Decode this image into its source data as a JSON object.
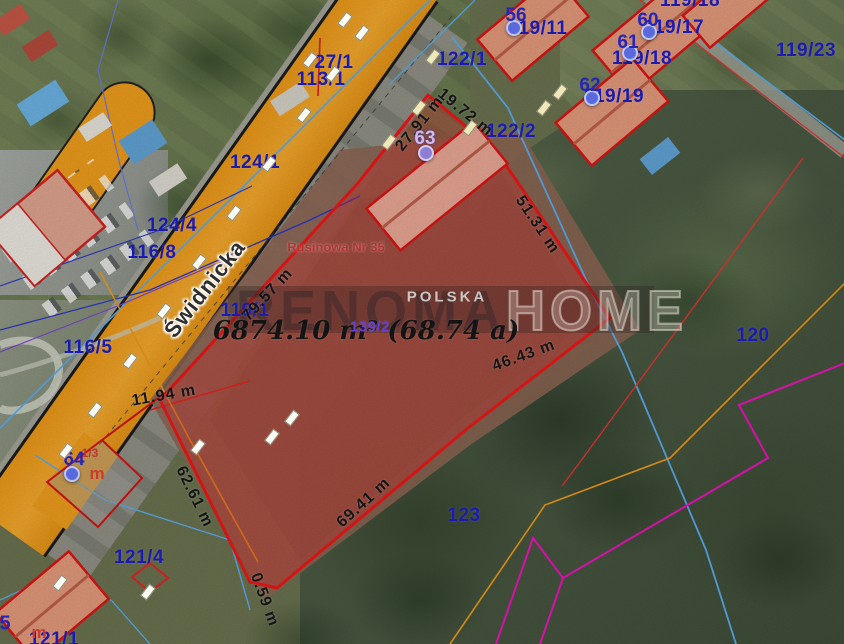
{
  "colors": {
    "parcel_outline": "#e81616",
    "parcel_fill": "rgba(221,40,40,0.33)",
    "soil_fill": "#8a6351",
    "road_orange": "#e8991c",
    "cadastral_blue": "#58a8e8",
    "cadastral_navy": "#2a35c0",
    "cadastral_purple": "#7744cc",
    "cadastral_magenta": "#ea12b8",
    "cadastral_orange": "#e8971a",
    "cadastral_red": "#dd3333",
    "label_blue": "#1b1bb0",
    "label_purple": "#6a3fd0",
    "measure_black": "#151515",
    "building_fill": "#dd9678",
    "building_outline": "#d41414",
    "marker_blue": "#5a6ade",
    "marker_purple": "#8d7fd6",
    "address_red": "#b43434"
  },
  "map": {
    "street_name": "Świdnicka",
    "address_text": "Rusinowa Nr 35",
    "country_watermark": "POLSKA",
    "area_text": "6874.10 m² (68.74 a)",
    "watermark": {
      "left": "RENOMA",
      "right": "HOME"
    },
    "parcel_labels": [
      {
        "text": "122/1",
        "x": 462,
        "y": 60
      },
      {
        "text": "27/1",
        "x": 334,
        "y": 63
      },
      {
        "text": "113/1",
        "x": 321,
        "y": 80
      },
      {
        "text": "124/1",
        "x": 255,
        "y": 163
      },
      {
        "text": "124/4",
        "x": 172,
        "y": 226
      },
      {
        "text": "116/8",
        "x": 152,
        "y": 253
      },
      {
        "text": "119/1",
        "x": 245,
        "y": 311
      },
      {
        "text": "116/5",
        "x": 88,
        "y": 348
      },
      {
        "text": "122/2",
        "x": 511,
        "y": 132
      },
      {
        "text": "119/23",
        "x": 806,
        "y": 51
      },
      {
        "text": "120",
        "x": 753,
        "y": 336
      },
      {
        "text": "123",
        "x": 464,
        "y": 516
      },
      {
        "text": "121/4",
        "x": 139,
        "y": 558
      },
      {
        "text": "121/1",
        "x": 54,
        "y": 640
      },
      {
        "text": "119/11",
        "x": 538,
        "y": 29
      },
      {
        "text": "119/17",
        "x": 674,
        "y": 28
      },
      {
        "text": "119/18",
        "x": 642,
        "y": 59
      },
      {
        "text": "119/19",
        "x": 614,
        "y": 97
      },
      {
        "text": "119/18",
        "x": 690,
        "y": 1
      },
      {
        "text": "139/2",
        "x": 370,
        "y": 327,
        "purple": true
      }
    ],
    "measure_labels": [
      {
        "text": "79.57 m",
        "x": 268,
        "y": 295,
        "rot": -47
      },
      {
        "text": "27.91 m",
        "x": 420,
        "y": 124,
        "rot": -51
      },
      {
        "text": "19.72 m",
        "x": 465,
        "y": 113,
        "rot": 39
      },
      {
        "text": "51.31 m",
        "x": 537,
        "y": 225,
        "rot": 56
      },
      {
        "text": "46.43 m",
        "x": 524,
        "y": 356,
        "rot": -20
      },
      {
        "text": "69.41 m",
        "x": 364,
        "y": 503,
        "rot": -42
      },
      {
        "text": "62.61 m",
        "x": 194,
        "y": 497,
        "rot": 64
      },
      {
        "text": "0.59 m",
        "x": 264,
        "y": 600,
        "rot": 70
      },
      {
        "text": "11.94 m",
        "x": 164,
        "y": 396,
        "rot": -10
      }
    ],
    "address_points": [
      {
        "number": "56",
        "x": 516,
        "y": 16,
        "dx": 514,
        "dy": 28,
        "variant": "blue"
      },
      {
        "number": "60",
        "x": 648,
        "y": 21,
        "dx": 649,
        "dy": 32,
        "variant": "blue"
      },
      {
        "number": "61",
        "x": 628,
        "y": 43,
        "dx": 630,
        "dy": 53,
        "variant": "blue"
      },
      {
        "number": "62",
        "x": 590,
        "y": 86,
        "dx": 592,
        "dy": 98,
        "variant": "blue"
      },
      {
        "number": "63",
        "x": 425,
        "y": 139,
        "dx": 426,
        "dy": 153,
        "variant": "purple"
      },
      {
        "number": "64",
        "x": 74,
        "y": 460,
        "dx": 72,
        "dy": 474,
        "variant": "blue"
      }
    ],
    "small_labels": [
      {
        "text": "1/3",
        "x": 90,
        "y": 453,
        "cls": "red-small"
      },
      {
        "text": "m",
        "x": 97,
        "y": 474,
        "cls": "red-m"
      },
      {
        "text": "m",
        "x": 39,
        "y": 633,
        "cls": "red-m"
      },
      {
        "text": "5",
        "x": 5,
        "y": 624,
        "cls": "blue-big"
      }
    ]
  }
}
